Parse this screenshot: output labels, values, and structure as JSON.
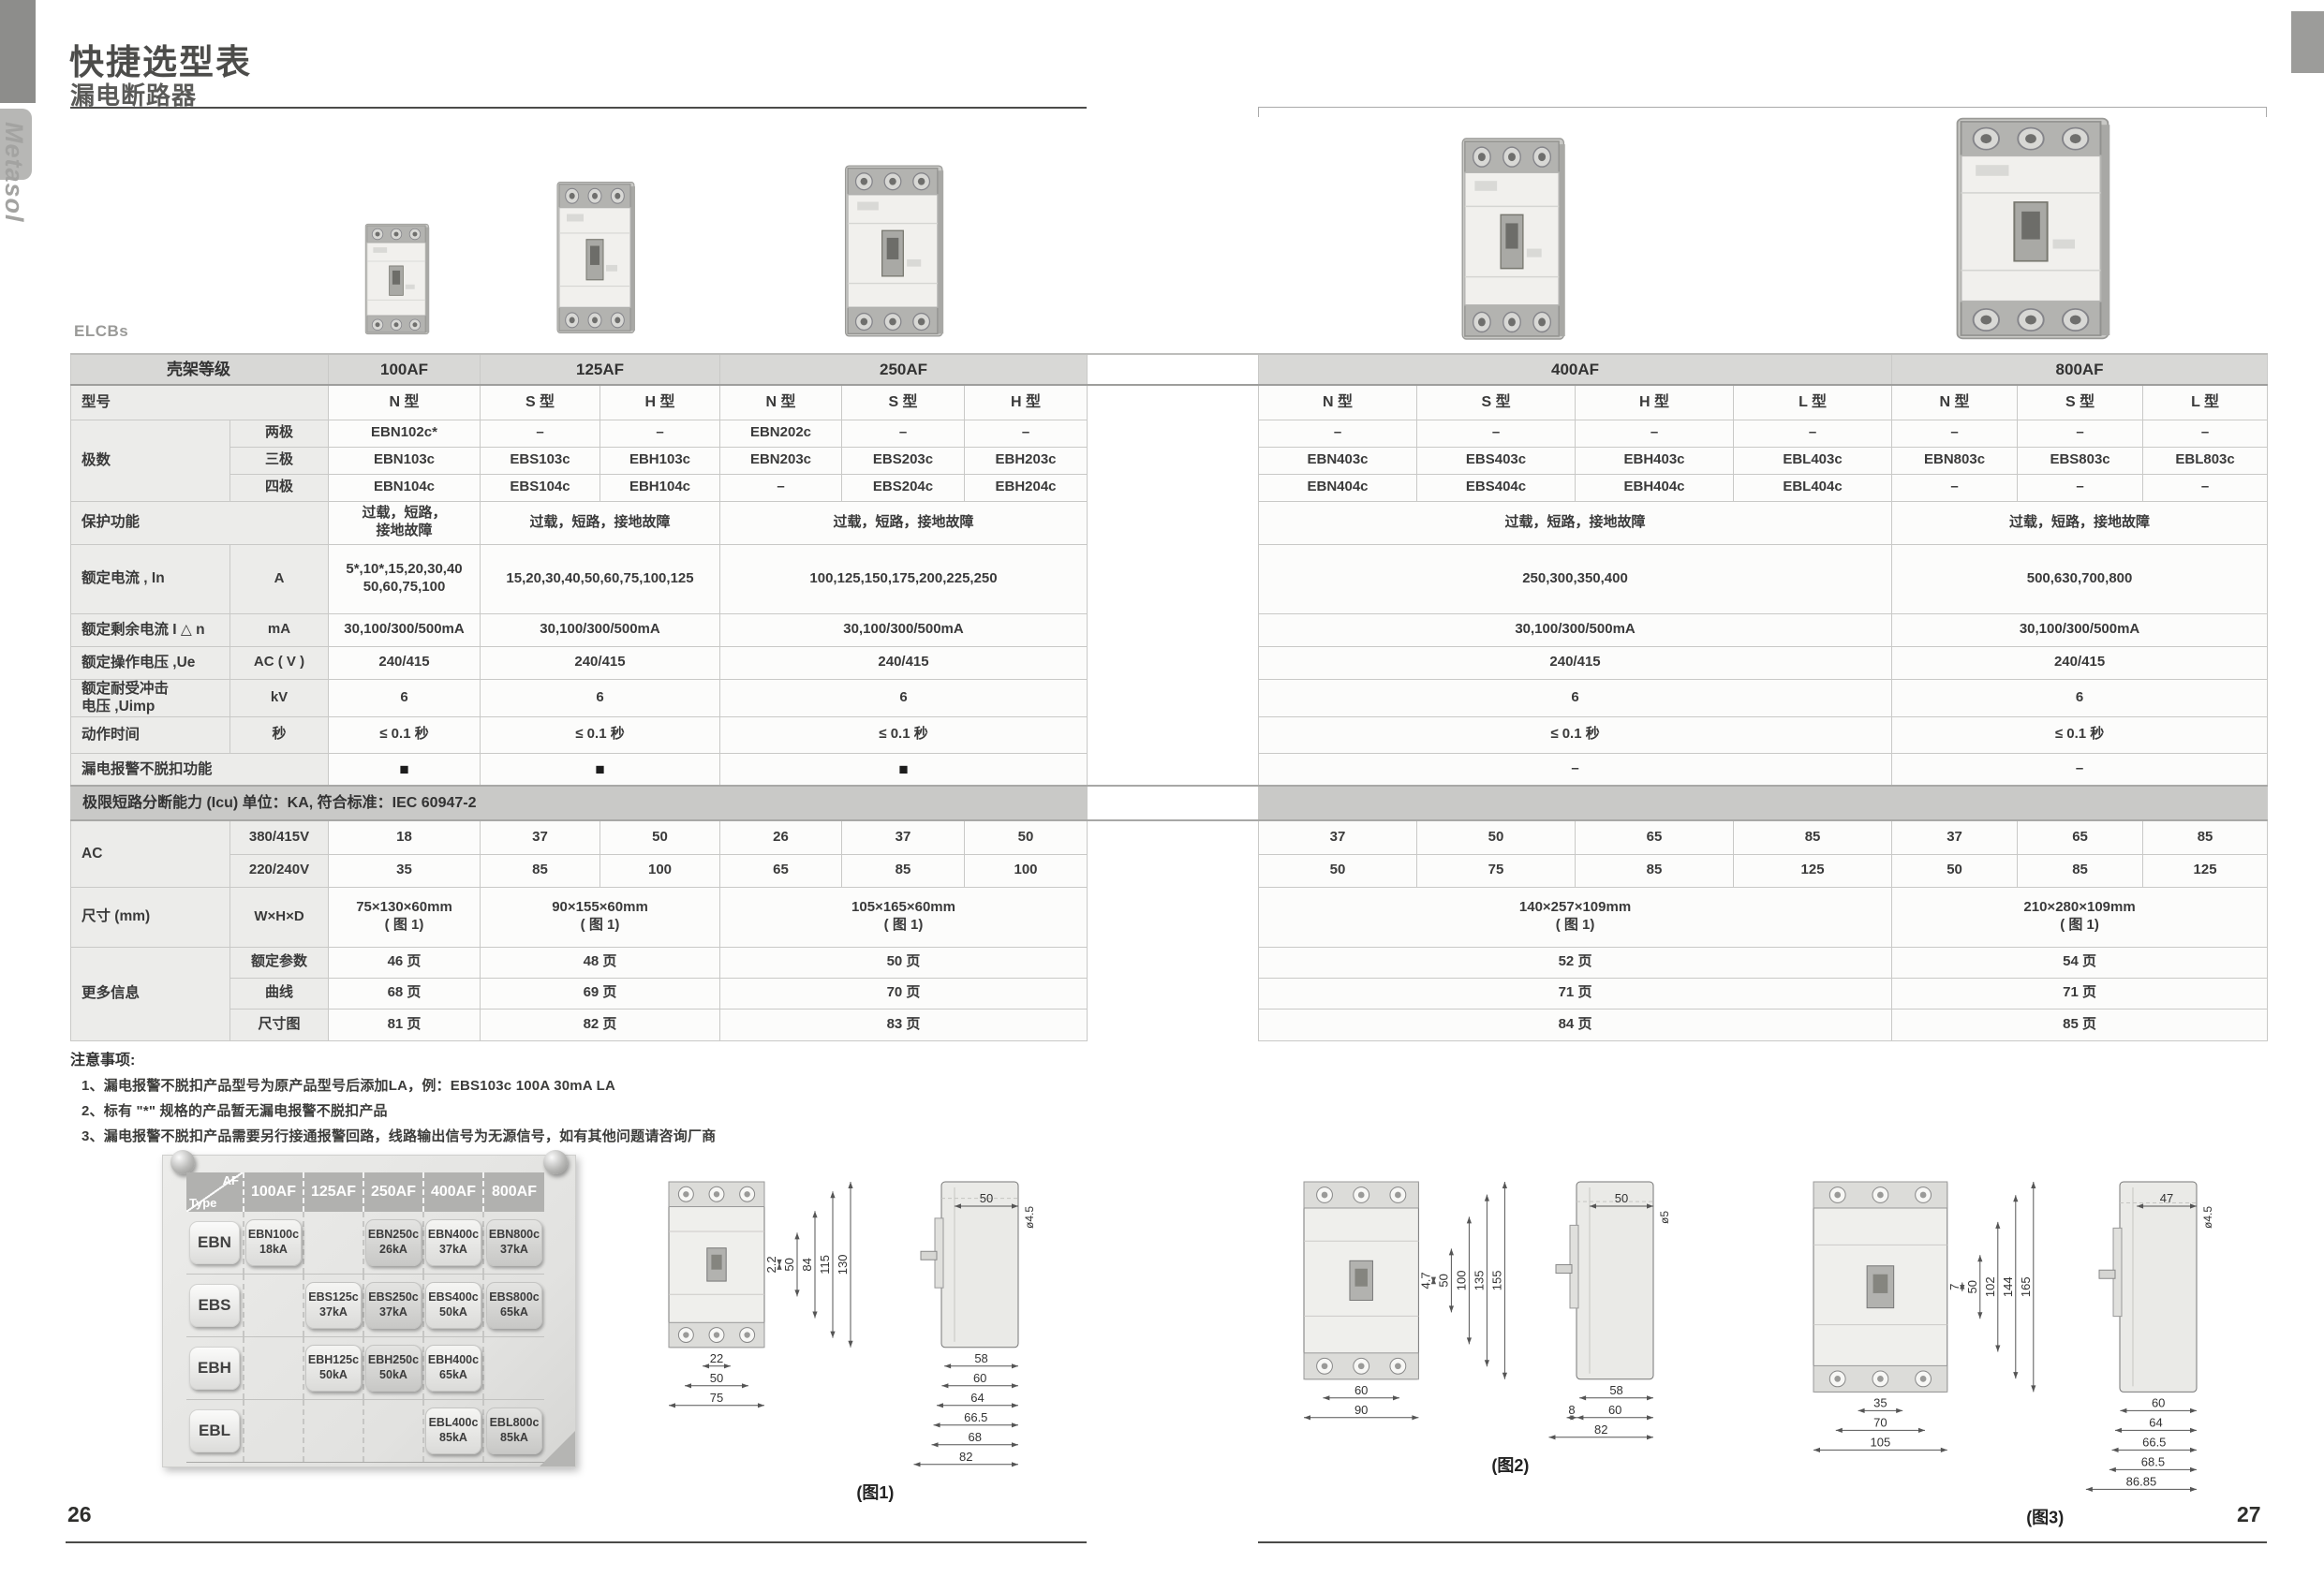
{
  "header": {
    "title": "快捷选型表",
    "subtitle": "漏电断路器",
    "brand": "Metasol",
    "elcbs_label": "ELCBs"
  },
  "colors": {
    "header_band": "#d8d8d6",
    "icu_band": "#c9c9c7",
    "label_bg": "#ececea",
    "text": "#3a3a3a"
  },
  "products": [
    {
      "name": "100AF"
    },
    {
      "name": "125AF"
    },
    {
      "name": "250AF"
    },
    {
      "name": "400AF"
    },
    {
      "name": "800AF"
    }
  ],
  "main_table": {
    "rows": [
      {
        "h": 33,
        "cls": "head",
        "cells": [
          {
            "t": "壳架等级",
            "s": 2,
            "c": "H hc"
          },
          {
            "t": "100AF",
            "c": "H"
          },
          {
            "t": "125AF",
            "s": 2,
            "c": "H"
          },
          {
            "t": "250AF",
            "s": 3,
            "c": "H"
          },
          {
            "t": "",
            "c": "G"
          },
          {
            "t": "400AF",
            "s": 4,
            "c": "H"
          },
          {
            "t": "800AF",
            "s": 3,
            "c": "H"
          }
        ]
      },
      {
        "h": 37,
        "cells": [
          {
            "t": "型号",
            "s": 2,
            "c": "A"
          },
          {
            "t": "N 型",
            "c": "tp"
          },
          {
            "t": "S 型",
            "c": "tp"
          },
          {
            "t": "H 型",
            "c": "tp"
          },
          {
            "t": "N 型",
            "c": "tp"
          },
          {
            "t": "S 型",
            "c": "tp"
          },
          {
            "t": "H 型",
            "c": "tp"
          },
          {
            "t": "",
            "c": "G"
          },
          {
            "t": "N 型",
            "c": "tp"
          },
          {
            "t": "S 型",
            "c": "tp"
          },
          {
            "t": "H 型",
            "c": "tp"
          },
          {
            "t": "L 型",
            "c": "tp"
          },
          {
            "t": "N 型",
            "c": "tp"
          },
          {
            "t": "S 型",
            "c": "tp"
          },
          {
            "t": "L 型",
            "c": "tp"
          }
        ]
      },
      {
        "h": 29,
        "cells": [
          {
            "t": "极数",
            "c": "A",
            "r": 3
          },
          {
            "t": "两极",
            "c": "B"
          },
          {
            "t": "EBN102c*"
          },
          {
            "t": "–"
          },
          {
            "t": "–"
          },
          {
            "t": "EBN202c"
          },
          {
            "t": "–"
          },
          {
            "t": "–"
          },
          {
            "t": "",
            "c": "G"
          },
          {
            "t": "–"
          },
          {
            "t": "–"
          },
          {
            "t": "–"
          },
          {
            "t": "–"
          },
          {
            "t": "–"
          },
          {
            "t": "–"
          },
          {
            "t": "–"
          }
        ]
      },
      {
        "h": 29,
        "cells": [
          {
            "t": "三极",
            "c": "B"
          },
          {
            "t": "EBN103c"
          },
          {
            "t": "EBS103c"
          },
          {
            "t": "EBH103c"
          },
          {
            "t": "EBN203c"
          },
          {
            "t": "EBS203c"
          },
          {
            "t": "EBH203c"
          },
          {
            "t": "",
            "c": "G"
          },
          {
            "t": "EBN403c"
          },
          {
            "t": "EBS403c"
          },
          {
            "t": "EBH403c"
          },
          {
            "t": "EBL403c"
          },
          {
            "t": "EBN803c"
          },
          {
            "t": "EBS803c"
          },
          {
            "t": "EBL803c"
          }
        ]
      },
      {
        "h": 29,
        "cells": [
          {
            "t": "四极",
            "c": "B"
          },
          {
            "t": "EBN104c"
          },
          {
            "t": "EBS104c"
          },
          {
            "t": "EBH104c"
          },
          {
            "t": "–"
          },
          {
            "t": "EBS204c"
          },
          {
            "t": "EBH204c"
          },
          {
            "t": "",
            "c": "G"
          },
          {
            "t": "EBN404c"
          },
          {
            "t": "EBS404c"
          },
          {
            "t": "EBH404c"
          },
          {
            "t": "EBL404c"
          },
          {
            "t": "–"
          },
          {
            "t": "–"
          },
          {
            "t": "–"
          }
        ]
      },
      {
        "h": 46,
        "cells": [
          {
            "t": "保护功能",
            "s": 2,
            "c": "A"
          },
          {
            "t": "过载，短路，\n接地故障"
          },
          {
            "t": "过载，短路，接地故障",
            "s": 2
          },
          {
            "t": "过载，短路，接地故障",
            "s": 3
          },
          {
            "t": "",
            "c": "G"
          },
          {
            "t": "过载，短路，接地故障",
            "s": 4
          },
          {
            "t": "过载，短路，接地故障",
            "s": 3
          }
        ]
      },
      {
        "h": 74,
        "cells": [
          {
            "t": "额定电流 , In",
            "c": "A"
          },
          {
            "t": "A",
            "c": "B"
          },
          {
            "t": "5*,10*,15,20,30,40\n50,60,75,100"
          },
          {
            "t": "15,20,30,40,50,60,75,100,125",
            "s": 2
          },
          {
            "t": "100,125,150,175,200,225,250",
            "s": 3
          },
          {
            "t": "",
            "c": "G"
          },
          {
            "t": "250,300,350,400",
            "s": 4
          },
          {
            "t": "500,630,700,800",
            "s": 3
          }
        ]
      },
      {
        "h": 35,
        "cells": [
          {
            "t": "额定剩余电流 I △ n",
            "c": "A"
          },
          {
            "t": "mA",
            "c": "B"
          },
          {
            "t": "30,100/300/500mA"
          },
          {
            "t": "30,100/300/500mA",
            "s": 2
          },
          {
            "t": "30,100/300/500mA",
            "s": 3
          },
          {
            "t": "",
            "c": "G"
          },
          {
            "t": "30,100/300/500mA",
            "s": 4
          },
          {
            "t": "30,100/300/500mA",
            "s": 3
          }
        ]
      },
      {
        "h": 35,
        "cells": [
          {
            "t": "额定操作电压 ,Ue",
            "c": "A"
          },
          {
            "t": "AC ( V )",
            "c": "B"
          },
          {
            "t": "240/415"
          },
          {
            "t": "240/415",
            "s": 2
          },
          {
            "t": "240/415",
            "s": 3
          },
          {
            "t": "",
            "c": "G"
          },
          {
            "t": "240/415",
            "s": 4
          },
          {
            "t": "240/415",
            "s": 3
          }
        ]
      },
      {
        "h": 40,
        "cells": [
          {
            "t": "额定耐受冲击\n电压 ,Uimp",
            "c": "A"
          },
          {
            "t": "kV",
            "c": "B"
          },
          {
            "t": "6"
          },
          {
            "t": "6",
            "s": 2
          },
          {
            "t": "6",
            "s": 3
          },
          {
            "t": "",
            "c": "G"
          },
          {
            "t": "6",
            "s": 4
          },
          {
            "t": "6",
            "s": 3
          }
        ]
      },
      {
        "h": 39,
        "cells": [
          {
            "t": "动作时间",
            "c": "A"
          },
          {
            "t": "秒",
            "c": "B"
          },
          {
            "t": "≤ 0.1 秒"
          },
          {
            "t": "≤ 0.1 秒",
            "s": 2
          },
          {
            "t": "≤ 0.1 秒",
            "s": 3
          },
          {
            "t": "",
            "c": "G"
          },
          {
            "t": "≤ 0.1 秒",
            "s": 4
          },
          {
            "t": "≤ 0.1 秒",
            "s": 3
          }
        ]
      },
      {
        "h": 35,
        "cells": [
          {
            "t": "漏电报警不脱扣功能",
            "s": 2,
            "c": "A"
          },
          {
            "t": "■",
            "c": "sq"
          },
          {
            "t": "■",
            "s": 2,
            "c": "sq"
          },
          {
            "t": "■",
            "s": 3,
            "c": "sq"
          },
          {
            "t": "",
            "c": "G"
          },
          {
            "t": "–",
            "s": 4
          },
          {
            "t": "–",
            "s": 3
          }
        ]
      },
      {
        "h": 37,
        "cls": "band",
        "cells": [
          {
            "t": "极限短路分断能力 (Icu) 单位：KA, 符合标准：IEC 60947-2",
            "s": 8,
            "c": "BAND"
          },
          {
            "t": "",
            "c": "G"
          },
          {
            "t": "",
            "s": 7,
            "c": "BAND"
          }
        ]
      },
      {
        "h": 36,
        "cells": [
          {
            "t": "AC",
            "c": "A",
            "r": 2
          },
          {
            "t": "380/415V",
            "c": "B"
          },
          {
            "t": "18"
          },
          {
            "t": "37"
          },
          {
            "t": "50"
          },
          {
            "t": "26"
          },
          {
            "t": "37"
          },
          {
            "t": "50"
          },
          {
            "t": "",
            "c": "G"
          },
          {
            "t": "37"
          },
          {
            "t": "50"
          },
          {
            "t": "65"
          },
          {
            "t": "85"
          },
          {
            "t": "37"
          },
          {
            "t": "65"
          },
          {
            "t": "85"
          }
        ]
      },
      {
        "h": 35,
        "cells": [
          {
            "t": "220/240V",
            "c": "B"
          },
          {
            "t": "35"
          },
          {
            "t": "85"
          },
          {
            "t": "100"
          },
          {
            "t": "65"
          },
          {
            "t": "85"
          },
          {
            "t": "100"
          },
          {
            "t": "",
            "c": "G"
          },
          {
            "t": "50"
          },
          {
            "t": "75"
          },
          {
            "t": "85"
          },
          {
            "t": "125"
          },
          {
            "t": "50"
          },
          {
            "t": "85"
          },
          {
            "t": "125"
          }
        ]
      },
      {
        "h": 64,
        "cells": [
          {
            "t": "尺寸 (mm)",
            "c": "A"
          },
          {
            "t": "W×H×D",
            "c": "B"
          },
          {
            "t": "75×130×60mm\n( 图 1)"
          },
          {
            "t": "90×155×60mm\n( 图 1)",
            "s": 2
          },
          {
            "t": "105×165×60mm\n( 图 1)",
            "s": 3
          },
          {
            "t": "",
            "c": "G"
          },
          {
            "t": "140×257×109mm\n( 图 1)",
            "s": 4
          },
          {
            "t": "210×280×109mm\n( 图 1)",
            "s": 3
          }
        ]
      },
      {
        "h": 33,
        "cells": [
          {
            "t": "更多信息",
            "c": "A",
            "r": 3
          },
          {
            "t": "额定参数",
            "c": "B"
          },
          {
            "t": "46 页"
          },
          {
            "t": "48 页",
            "s": 2
          },
          {
            "t": "50 页",
            "s": 3
          },
          {
            "t": "",
            "c": "G"
          },
          {
            "t": "52 页",
            "s": 4
          },
          {
            "t": "54 页",
            "s": 3
          }
        ]
      },
      {
        "h": 33,
        "cells": [
          {
            "t": "曲线",
            "c": "B"
          },
          {
            "t": "68 页"
          },
          {
            "t": "69 页",
            "s": 2
          },
          {
            "t": "70 页",
            "s": 3
          },
          {
            "t": "",
            "c": "G"
          },
          {
            "t": "71 页",
            "s": 4
          },
          {
            "t": "71 页",
            "s": 3
          }
        ]
      },
      {
        "h": 34,
        "cells": [
          {
            "t": "尺寸图",
            "c": "B"
          },
          {
            "t": "81 页"
          },
          {
            "t": "82 页",
            "s": 2
          },
          {
            "t": "83 页",
            "s": 3
          },
          {
            "t": "",
            "c": "G"
          },
          {
            "t": "84 页",
            "s": 4
          },
          {
            "t": "85 页",
            "s": 3
          }
        ]
      }
    ]
  },
  "notes": {
    "heading": "注意事项:",
    "items": [
      "1、漏电报警不脱扣产品型号为原产品型号后添加LA，例：EBS103c 100A 30mA LA",
      "2、标有 \"*\" 规格的产品暂无漏电报警不脱扣产品",
      "3、漏电报警不脱扣产品需要另行接通报警回路，线路输出信号为无源信号，如有其他问题请咨询厂商"
    ]
  },
  "matrix": {
    "corner_top": "AF",
    "corner_bottom": "Type",
    "columns": [
      "100AF",
      "125AF",
      "250AF",
      "400AF",
      "800AF"
    ],
    "rows": [
      {
        "type": "EBN",
        "cells": [
          {
            "model": "EBN100c",
            "ka": "18kA"
          },
          null,
          {
            "model": "EBN250c",
            "ka": "26kA",
            "dark": true
          },
          {
            "model": "EBN400c",
            "ka": "37kA"
          },
          {
            "model": "EBN800c",
            "ka": "37kA",
            "dark": true
          }
        ]
      },
      {
        "type": "EBS",
        "cells": [
          null,
          {
            "model": "EBS125c",
            "ka": "37kA"
          },
          {
            "model": "EBS250c",
            "ka": "37kA",
            "dark": true
          },
          {
            "model": "EBS400c",
            "ka": "50kA"
          },
          {
            "model": "EBS800c",
            "ka": "65kA",
            "dark": true
          }
        ]
      },
      {
        "type": "EBH",
        "cells": [
          null,
          {
            "model": "EBH125c",
            "ka": "50kA"
          },
          {
            "model": "EBH250c",
            "ka": "50kA",
            "dark": true
          },
          {
            "model": "EBH400c",
            "ka": "65kA"
          },
          null
        ]
      },
      {
        "type": "EBL",
        "cells": [
          null,
          null,
          null,
          {
            "model": "EBL400c",
            "ka": "85kA"
          },
          {
            "model": "EBL800c",
            "ka": "85kA",
            "dark": true
          }
        ]
      }
    ]
  },
  "figures": [
    {
      "caption": "(图1)",
      "front_dims_v": [
        "2.2",
        "50",
        "84",
        "115",
        "130"
      ],
      "front_dims_b": [
        "22",
        "50",
        "75"
      ],
      "side_top": "50",
      "side_dia": "ø4.5",
      "side_dims": [
        "58",
        "60",
        "64",
        "66.5",
        "68",
        "82"
      ]
    },
    {
      "caption": "(图2)",
      "front_dims_v": [
        "4.7",
        "50",
        "100",
        "135",
        "155"
      ],
      "front_dims_b": [
        "60",
        "90"
      ],
      "side_top": "50",
      "side_dia": "ø5",
      "side_dims": [
        "58",
        "8|60",
        "82"
      ]
    },
    {
      "caption": "(图3)",
      "front_dims_v": [
        "7",
        "50",
        "102",
        "144",
        "165"
      ],
      "front_dims_b": [
        "35",
        "70",
        "105"
      ],
      "side_top": "47",
      "side_dia": "ø4.5",
      "side_dims": [
        "60",
        "64",
        "66.5",
        "68.5",
        "86.85"
      ]
    }
  ],
  "footer": {
    "left_page": "26",
    "right_page": "27"
  }
}
